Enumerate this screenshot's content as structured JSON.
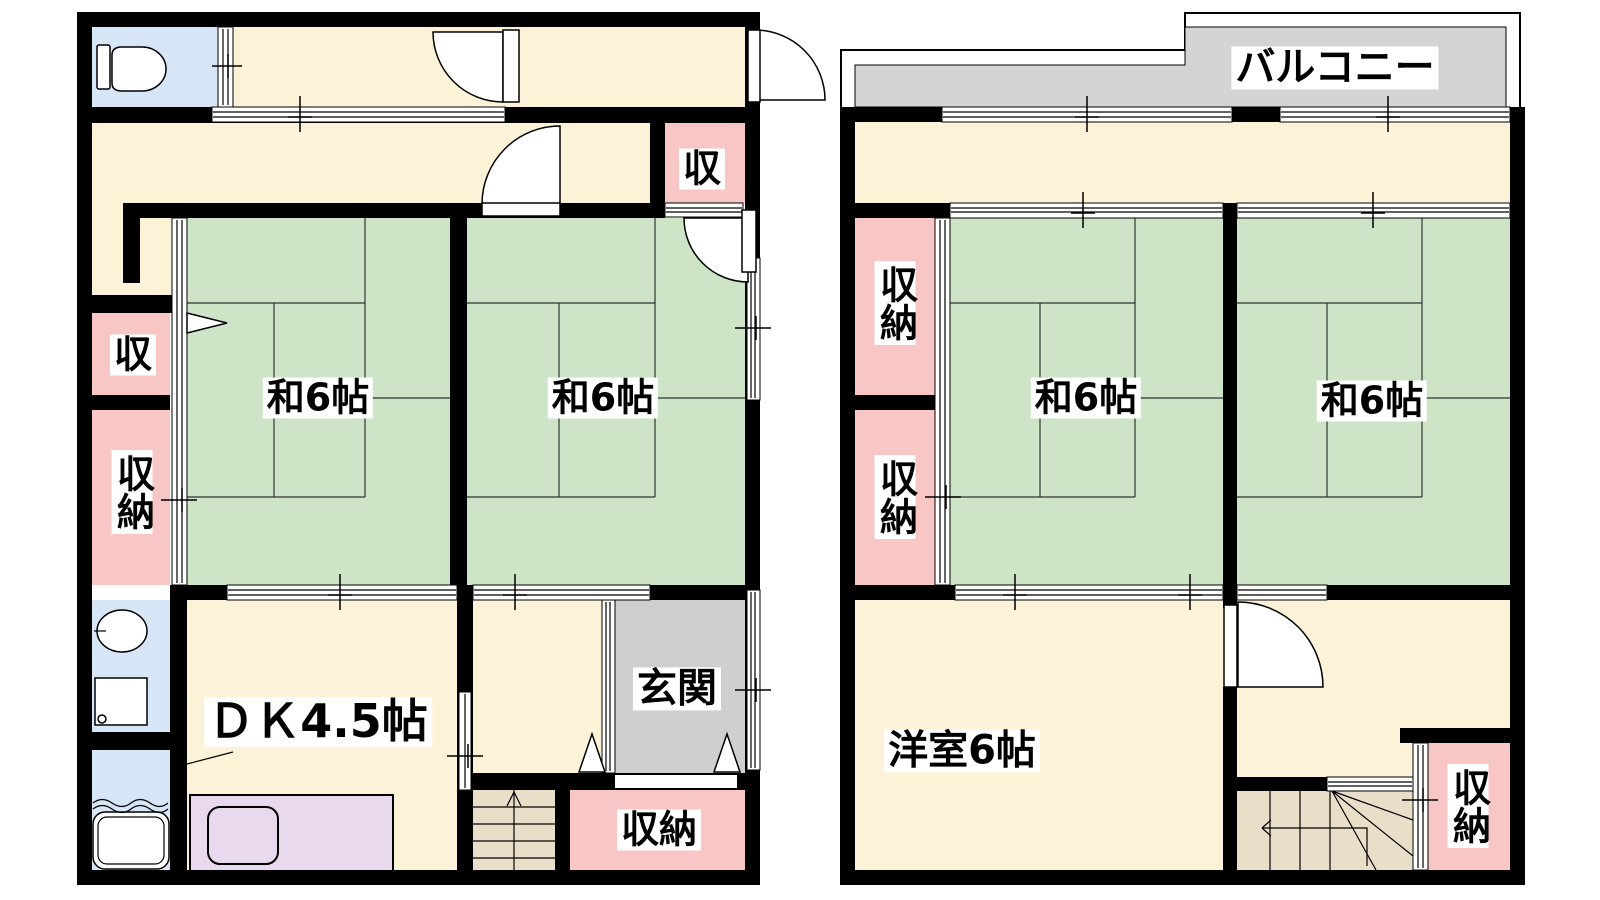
{
  "colors": {
    "wall": "#000000",
    "tatami": "#cde5c6",
    "hall": "#fcf2d8",
    "storage": "#f9c6c6",
    "water": "#d6e6f6",
    "entrance_gray": "#cfcfcf",
    "balcony_gray": "#d4d4d4",
    "stairs": "#e9dfc9",
    "kitchen": "#e8d9ef",
    "tatami_line": "#333333",
    "label_bg": "#ffffff",
    "text": "#000000"
  },
  "floor1": {
    "rooms": {
      "washitsu1": {
        "label": "和6帖"
      },
      "washitsu2": {
        "label": "和6帖"
      },
      "dk": {
        "label": "ＤＫ4.5帖"
      },
      "genkan": {
        "label": "玄関"
      },
      "storage_upper_right": {
        "label": "収"
      },
      "storage_left_upper": {
        "label": "収"
      },
      "storage_left_lower": {
        "label": "収納"
      },
      "storage_entrance": {
        "label": "収納"
      }
    }
  },
  "floor2": {
    "balcony": {
      "label": "バルコニー"
    },
    "rooms": {
      "washitsu1": {
        "label": "和6帖"
      },
      "washitsu2": {
        "label": "和6帖"
      },
      "youshitsu": {
        "label": "洋室6帖"
      },
      "storage_upper": {
        "label": "収納"
      },
      "storage_middle": {
        "label": "収納"
      },
      "storage_lower": {
        "label": "収納"
      }
    }
  }
}
